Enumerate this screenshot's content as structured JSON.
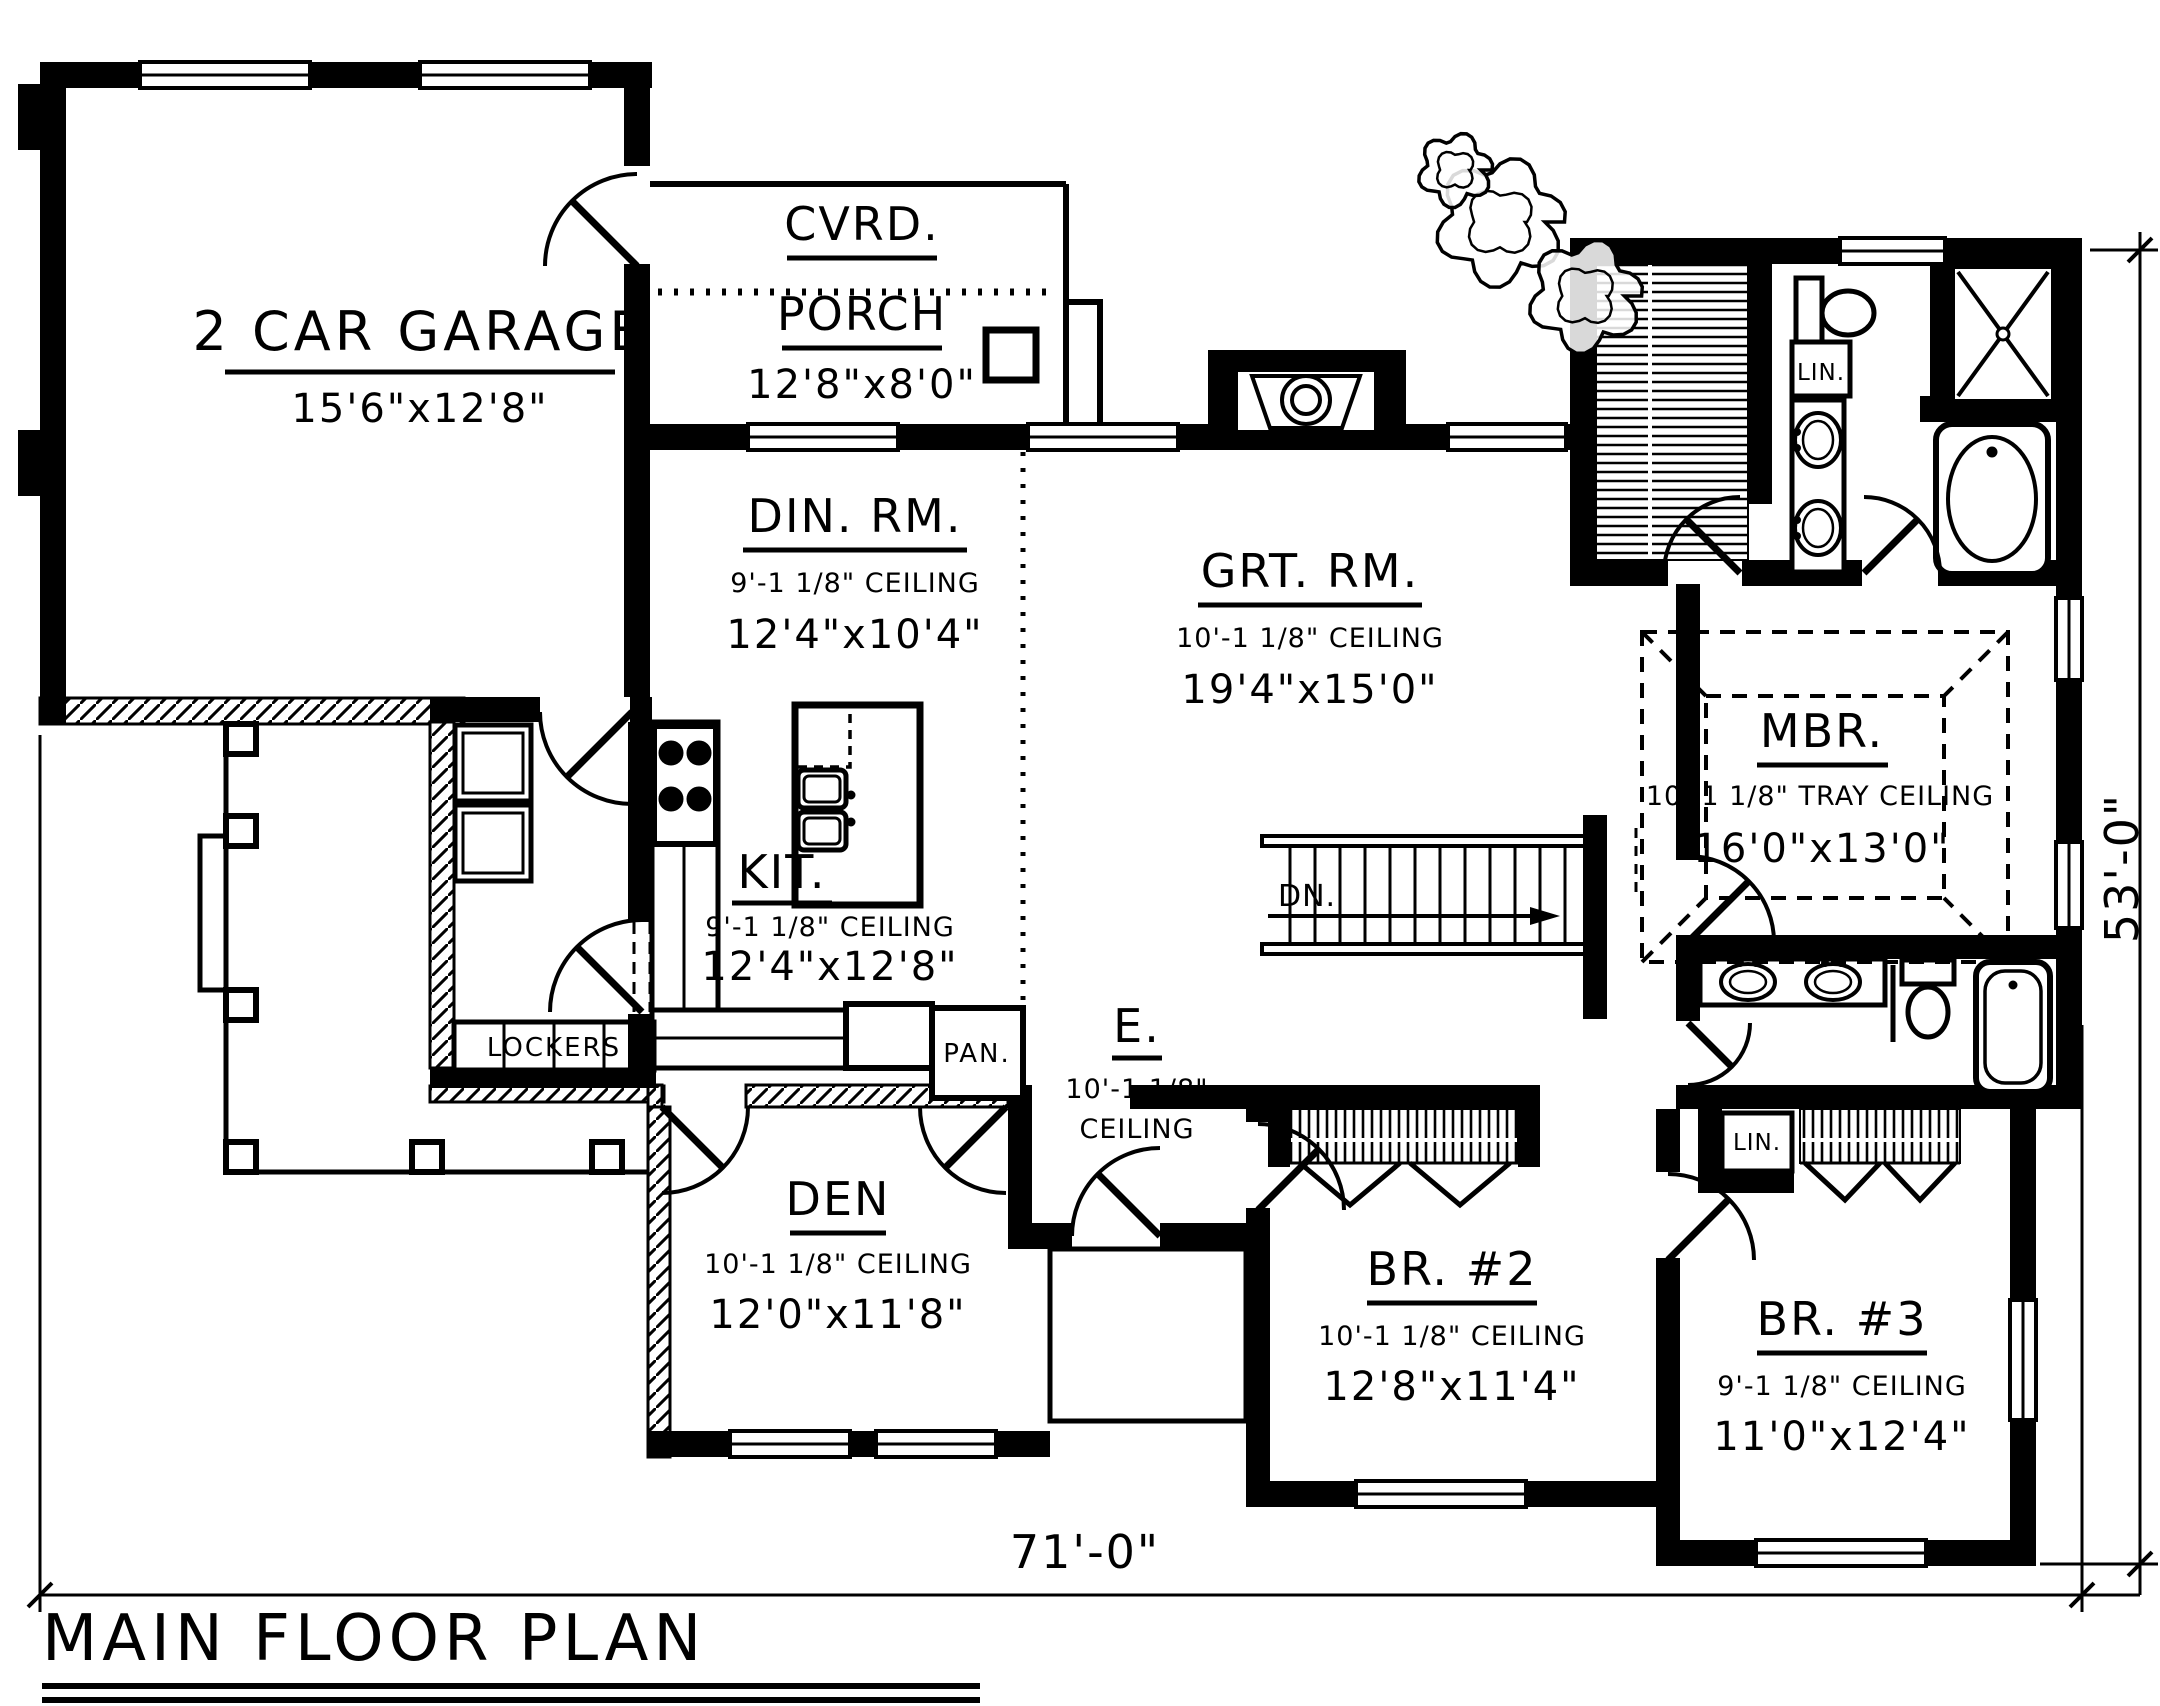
{
  "title": {
    "text": "MAIN FLOOR PLAN"
  },
  "dims": {
    "width": "71'-0\"",
    "height": "53'-0\""
  },
  "rooms": {
    "garage": {
      "name": "2 CAR GARAGE",
      "size": "15'6\"x12'8\""
    },
    "porch": {
      "line1": "CVRD.",
      "line2": "PORCH",
      "size": "12'8\"x8'0\""
    },
    "dining": {
      "name": "DIN. RM.",
      "ceiling": "9'-1 1/8\" CEILING",
      "size": "12'4\"x10'4\""
    },
    "great": {
      "name": "GRT. RM.",
      "ceiling": "10'-1 1/8\" CEILING",
      "size": "19'4\"x15'0\""
    },
    "master": {
      "name": "MBR.",
      "ceiling": "10'-1 1/8\" TRAY CEILING",
      "size": "16'0\"x13'0\""
    },
    "kitchen": {
      "name": "KIT.",
      "ceiling": "9'-1 1/8\" CEILING",
      "size": "12'4\"x12'8\""
    },
    "entry": {
      "name": "E.",
      "ceiling1": "10'-1 1/8\"",
      "ceiling2": "CEILING"
    },
    "den": {
      "name": "DEN",
      "ceiling": "10'-1 1/8\" CEILING",
      "size": "12'0\"x11'8\""
    },
    "br2": {
      "name": "BR. #2",
      "ceiling": "10'-1 1/8\" CEILING",
      "size": "12'8\"x11'4\""
    },
    "br3": {
      "name": "BR. #3",
      "ceiling": "9'-1 1/8\" CEILING",
      "size": "11'0\"x12'4\""
    }
  },
  "labels": {
    "lockers": "LOCKERS",
    "pantry": "PAN.",
    "linen_master": "LIN.",
    "linen_hall": "LIN.",
    "stairs_down": "DN."
  },
  "colors": {
    "ink": "#000000",
    "paper": "#ffffff"
  }
}
